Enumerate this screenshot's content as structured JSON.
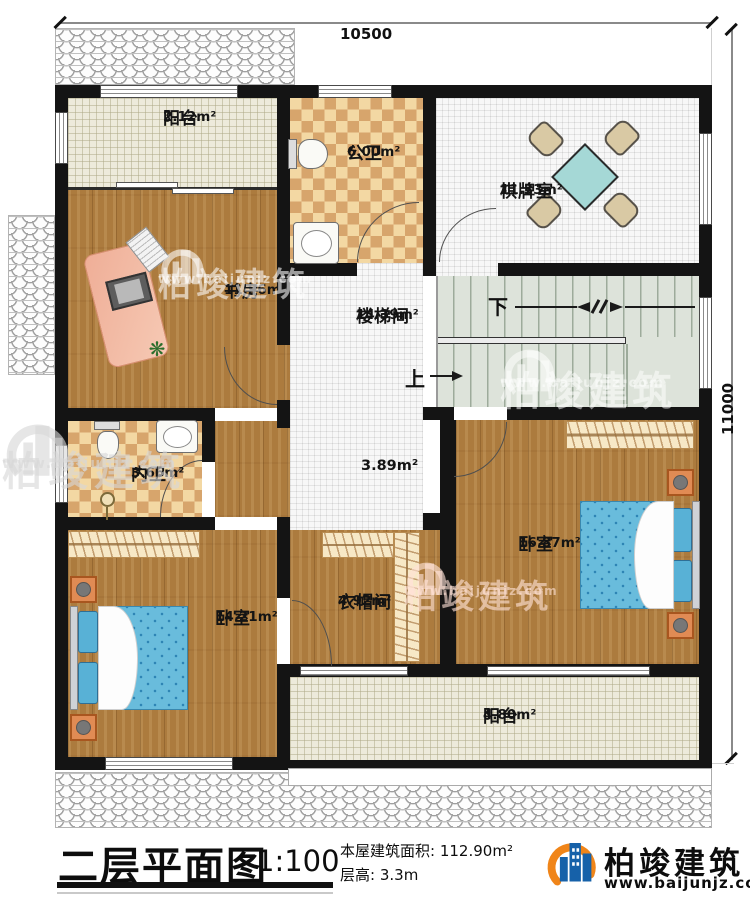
{
  "dimensions": {
    "width_label": "10500",
    "height_label": "11000"
  },
  "rooms": [
    {
      "id": "balcony-top",
      "name": "阳台",
      "area": "2.12m²"
    },
    {
      "id": "public-bath",
      "name": "公卫",
      "area": "6.00m²"
    },
    {
      "id": "game-room",
      "name": "棋牌室",
      "area": "11.33m²"
    },
    {
      "id": "study",
      "name": "书房",
      "area": "11.96m²"
    },
    {
      "id": "stair-hall",
      "name": "楼梯间",
      "area": "14.39m²"
    },
    {
      "id": "corridor",
      "name": "",
      "area": "3.89m²"
    },
    {
      "id": "inner-bath",
      "name": "内卫",
      "area": "3.66m²"
    },
    {
      "id": "bedroom-right",
      "name": "卧室",
      "area": "16.87m²"
    },
    {
      "id": "cloakroom",
      "name": "衣帽间",
      "area": "4.92m²"
    },
    {
      "id": "bedroom-left",
      "name": "卧室",
      "area": "14.21m²"
    },
    {
      "id": "balcony-bottom",
      "name": "阳台",
      "area": "4.80m²"
    }
  ],
  "stairs": {
    "down_label": "下",
    "up_label": "上"
  },
  "watermark": {
    "brand": "柏竣建筑",
    "url": "www.baijunjz.com"
  },
  "footer": {
    "title": "二层平面图",
    "scale": "1:100",
    "area_label": "本屋建筑面积:",
    "area_value": "112.90m²",
    "height_label": "层高:",
    "height_value": "3.3m",
    "brand": "柏竣建筑",
    "url": "www.baijunjz.com"
  },
  "colors": {
    "wall": "#141414",
    "accent_orange": "#f08519",
    "brand_blue": "#1661a9",
    "bed_blue": "#69bcdc"
  }
}
